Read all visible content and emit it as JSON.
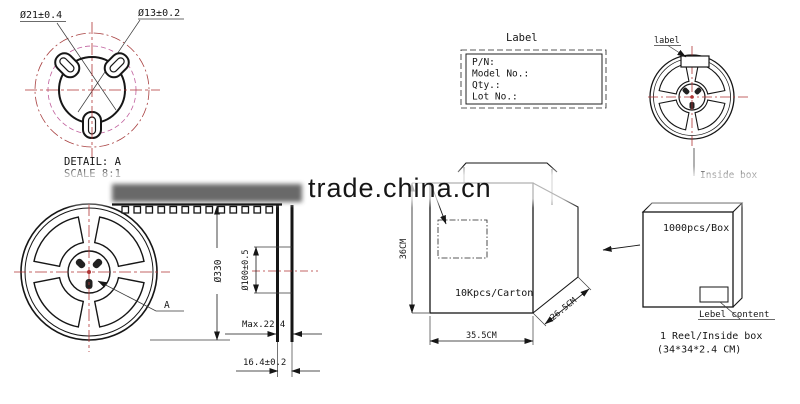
{
  "watermark": {
    "text": "trade.china.cn",
    "color": "#9b9b9b"
  },
  "detail_a": {
    "dim_hub_outer": "Ø21±0.4",
    "dim_hub_hole": "Ø13±0.2",
    "title": "DETAIL: A",
    "scale": "SCALE 8:1"
  },
  "reel_front": {
    "diameter": "Ø330",
    "detail_ref": "A"
  },
  "reel_side": {
    "hub_diameter": "Ø100±0.5",
    "max_width": "Max.22.4",
    "inner_width": "16.4±0.2"
  },
  "label_box": {
    "title": "Label",
    "fields": [
      "P/N:",
      "Model No.:",
      "Qty.:",
      "Lot No.:"
    ]
  },
  "reel_small": {
    "label_callout": "label",
    "inside_box_caption": "Inside box"
  },
  "inside_box": {
    "capacity": "1000pcs/Box",
    "label_callout": "Lebel content",
    "note_line1": "1 Reel/Inside box",
    "note_line2": "(34*34*2.4 CM)"
  },
  "carton": {
    "capacity": "10Kpcs/Carton",
    "height": "36CM",
    "width": "35.5CM",
    "depth": "26.5CM"
  },
  "colors": {
    "line": "#161616",
    "centerline": "#b03434",
    "detail_inner_circle": "#c0609d",
    "watermark": "#9b9b9b"
  }
}
